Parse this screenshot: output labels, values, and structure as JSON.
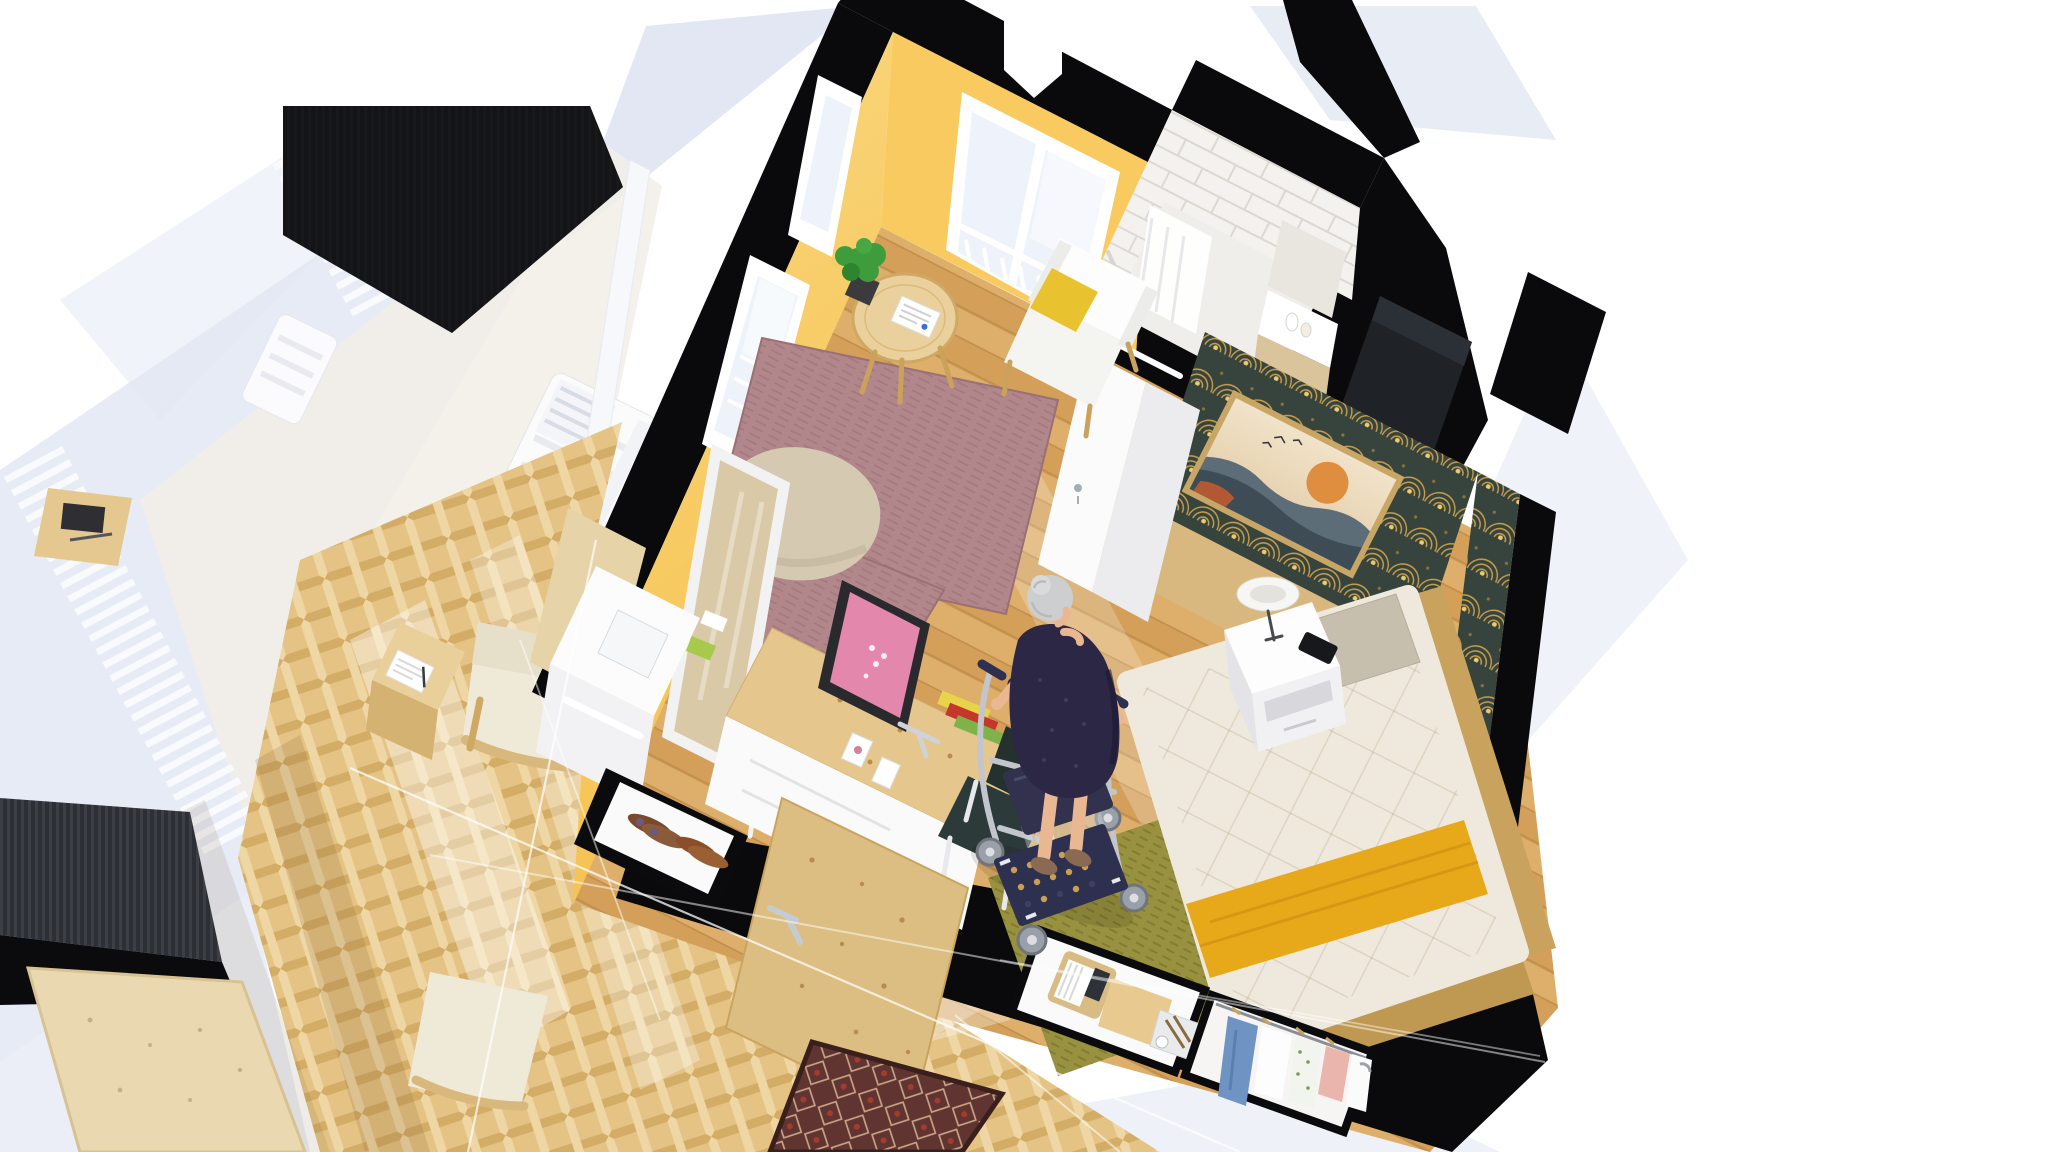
{
  "scene": {
    "type": "3d-floorplan-cutaway",
    "description": "Isometric 3D cutaway rendering of a small senior-living studio apartment. An elderly woman with a rollator walker stands in the middle of a wood-floored room with yellow walls, a bed with a yellow throw, an art-deco accent wall with a sunset painting, a desk with a pink monitor, a white armchair, rugs, a tiled bathroom, an entry door with oriental doormat, a shoe niche, linen and clothes storage niches, and a balcony with white railing outside.",
    "rooms": [
      "living-bedroom",
      "bathroom",
      "entry",
      "balcony",
      "exterior-hallway"
    ],
    "objects": [
      "bed",
      "yellow-throw",
      "pillow",
      "nightstand",
      "table-lamp",
      "phone",
      "olive-rug",
      "mauve-rug",
      "pouf",
      "white-armchair",
      "yellow-cushion",
      "side-table",
      "potted-plant",
      "magazine",
      "desk",
      "pink-monitor",
      "books",
      "photo-frames",
      "desk-chair",
      "leaning-mirror",
      "coat-rack",
      "wash-cabinet",
      "towel-bar",
      "shoe-niche",
      "shoes",
      "entry-door",
      "oriental-doormat",
      "linen-niche",
      "magazine-box",
      "linen-box",
      "stationery-tray",
      "clothes-rail",
      "jeans",
      "shirts",
      "floral-dress",
      "pink-top",
      "art-deco-wallpaper",
      "sunset-painting",
      "subway-tiles",
      "shower-curtain",
      "grab-bar",
      "vanity",
      "balcony-bench",
      "railing",
      "lounge-armchair",
      "cube-table",
      "notebook",
      "herringbone-parquet",
      "rollator-walker",
      "guide-lines"
    ],
    "person": {
      "role": "elderly-woman",
      "hair": "gray bun",
      "clothing": "dark navy dress",
      "activity": "walking with rollator walker"
    }
  },
  "palette": {
    "bg": "#ffffff",
    "shadow_blue": "#e2e7f3",
    "shadow_blue_soft": "#eaeef7",
    "wall_black": "#0a0a0c",
    "wall_dark_striped": "#2c2f34",
    "yellow_wall": "#f8ca5f",
    "yellow_wall_deep": "#f2bb47",
    "wood_floor": "#d9a660",
    "wood_floor_dark": "#c08e4b",
    "wood_floor_light": "#e2b575",
    "herringbone": "#e4c384",
    "herringbone_dark": "#d3ac66",
    "parquet_pale": "#f2efe7",
    "tile_white": "#f4f2ee",
    "tile_grout": "#dcd8d1",
    "bathroom_floor": "#efeeea",
    "accent_teal": "#37433d",
    "accent_gold": "#c9a14d",
    "headboard_wood": "#d8b87f",
    "painting_sky": "#eddcc0",
    "painting_sun": "#df8d3e",
    "painting_mountain": "#5d6d77",
    "painting_dark": "#3e4c56",
    "mattress": "#efe9dd",
    "throw_yellow": "#e7a91a",
    "pillow_gray": "#c6bfae",
    "bedframe_wood": "#c9a35e",
    "olive_rug": "#98913f",
    "olive_dark": "#837c31",
    "mauve_rug": "#b2878b",
    "mauve_dark": "#a47a7e",
    "pouf": "#d5cab1",
    "desk_wood": "#e5c78e",
    "chair_green": "#2c3a39",
    "monitor_pink": "#e387ac",
    "mirror_reflection": "#d9c9a7",
    "door_wood": "#dcbd82",
    "doormat_red": "#5f3431",
    "doormat_cream": "#c8a488",
    "skin": "#eab793",
    "hair_gray": "#cdced0",
    "dress_navy": "#2c2745",
    "walker_navy": "#32324e",
    "walker_metal": "#c2c6cc",
    "jeans_blue": "#6f94c4",
    "blouse_pink": "#e9b5ac",
    "plant_green": "#3e9c3c",
    "boucle_cream": "#efe9d8",
    "white_furniture": "#fafafa",
    "railing_white": "#f8fafd",
    "glass_frame": "#f7f8fb"
  }
}
